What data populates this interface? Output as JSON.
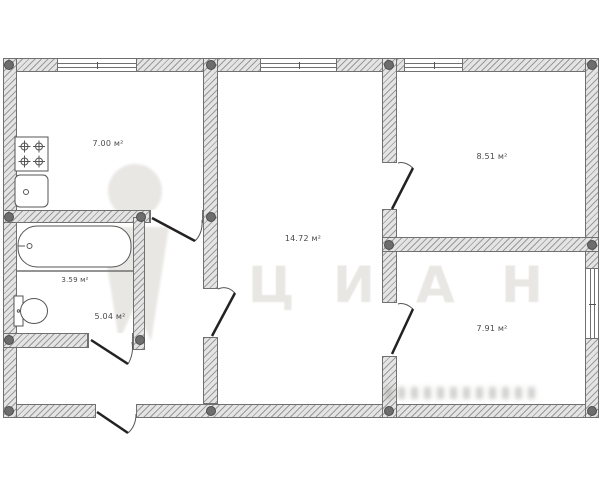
{
  "plan": {
    "type": "apartment-floor-plan",
    "rooms": [
      {
        "name": "kitchen",
        "area_label": "7.00 м²"
      },
      {
        "name": "living-room",
        "area_label": "14.72 м²"
      },
      {
        "name": "bedroom-top-right",
        "area_label": "8.51 м²"
      },
      {
        "name": "bedroom-bottom-right",
        "area_label": "7.91 м²"
      },
      {
        "name": "bathroom",
        "area_label": "3.59 м²"
      },
      {
        "name": "toilet",
        "area_label": "5.04 м²"
      }
    ],
    "fixtures": [
      "stove",
      "kitchen-sink",
      "bathtub",
      "toilet"
    ],
    "windows_count": 4,
    "doors_count": 6,
    "watermark": {
      "brand": "ЦИАН",
      "letters": [
        "Ц",
        "И",
        "А",
        "Н"
      ]
    },
    "colors": {
      "wall_fill": "#e4e4e4",
      "wall_hatch": "#9a9a9a",
      "wall_outline": "#707070",
      "column_fill": "#6d6d6d",
      "door_leaf": "#222222",
      "door_arc": "#555555",
      "fixture_stroke": "#555555",
      "label_text": "#4a4a4a",
      "watermark_color": "#e9e7e4"
    }
  }
}
